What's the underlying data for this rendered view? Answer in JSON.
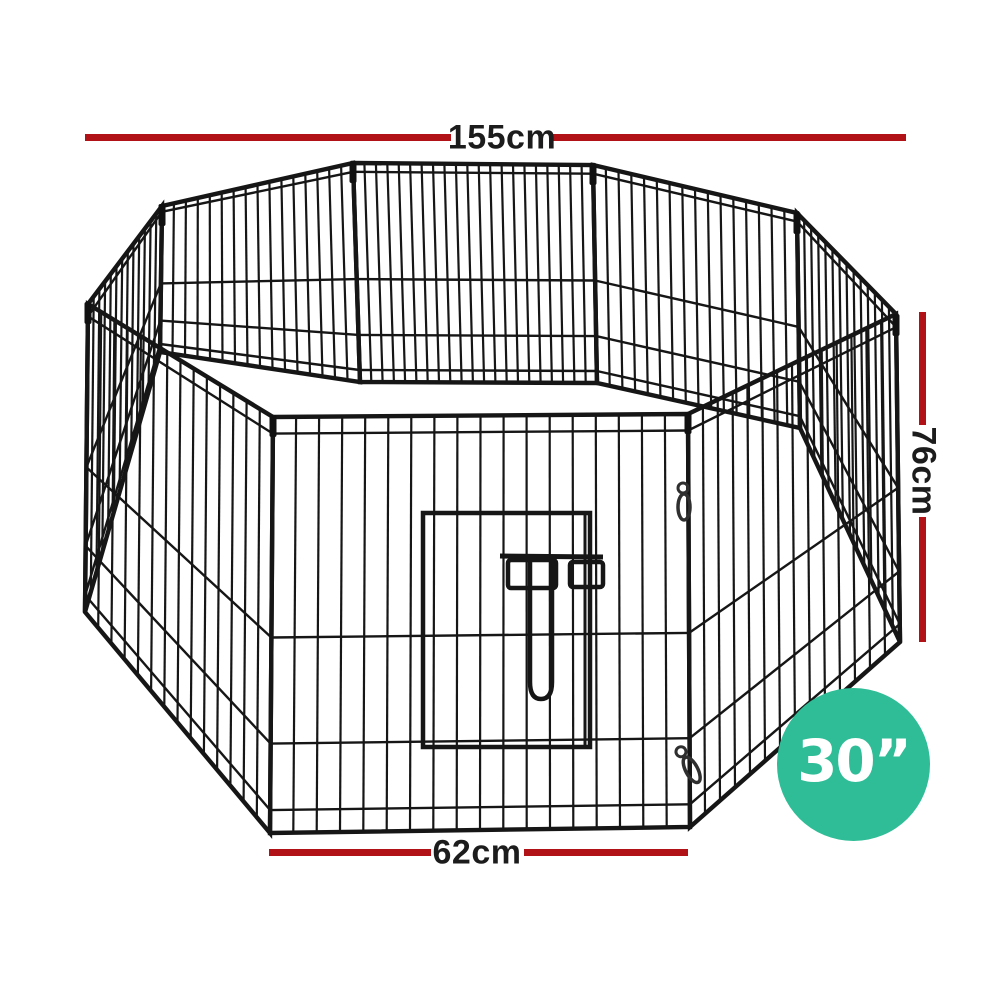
{
  "annotations": {
    "width_label": "155cm",
    "height_label": "76cm",
    "panel_width_label": "62cm",
    "line_color": "#b01217",
    "label_color": "#1c1c1c"
  },
  "badge": {
    "label": "30”",
    "background_color": "#2ebd96",
    "text_color": "#ffffff"
  },
  "illustration": {
    "subject": "8-panel octagonal wire pet playpen with front door",
    "wire_color": "#161616"
  }
}
